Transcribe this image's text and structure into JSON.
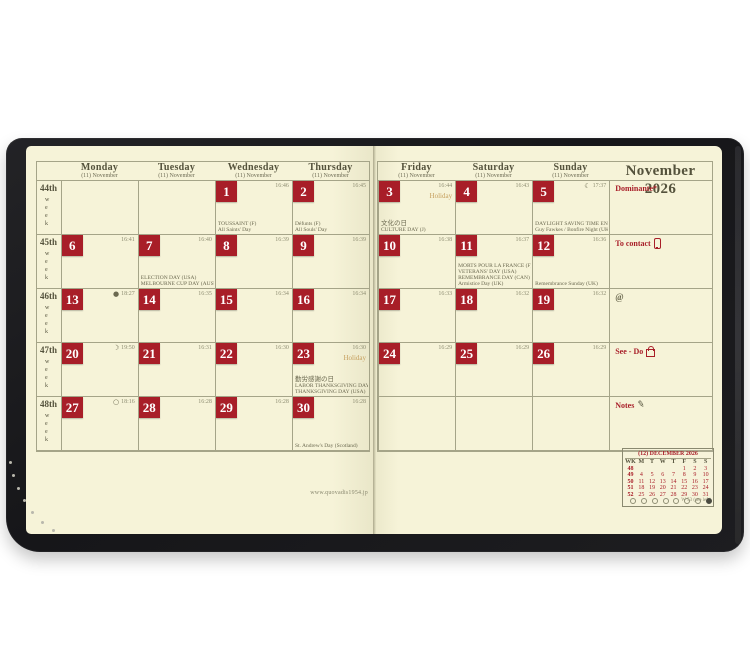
{
  "brand_url": "www.quovadis1954.jp",
  "colors": {
    "paper": "#f6f3d8",
    "cover": "#1a1a1d",
    "red": "#a81e28",
    "ink": "#54523c",
    "grid": "#a5a488",
    "faint": "#8e8d72",
    "tan": "#c6a05f",
    "note": "#6b6950"
  },
  "left_page": {
    "headers": [
      {
        "name": "Monday",
        "sub": "(11) November"
      },
      {
        "name": "Tuesday",
        "sub": "(11) November"
      },
      {
        "name": "Wednesday",
        "sub": "(11) November"
      },
      {
        "name": "Thursday",
        "sub": "(11) November"
      }
    ]
  },
  "right_page": {
    "headers": [
      {
        "name": "Friday",
        "sub": "(11) November"
      },
      {
        "name": "Saturday",
        "sub": "(11) November"
      },
      {
        "name": "Sunday",
        "sub": "(11) November"
      }
    ],
    "month_title": "November 2026",
    "sidebar": [
      {
        "label": "Dominante*",
        "icon": "none"
      },
      {
        "label": "To contact",
        "icon": "phone"
      },
      {
        "label": "@",
        "icon": "none",
        "muted": true
      },
      {
        "label": "See - Do",
        "icon": "bag"
      },
      {
        "label": "Notes",
        "icon": "pen"
      }
    ]
  },
  "weeks": [
    "44th",
    "45th",
    "46th",
    "47th",
    "48th"
  ],
  "week_word": "week",
  "grid_rows": [
    [
      null,
      null,
      {
        "day": "1",
        "time": "16:46",
        "lines": [
          "TOUSSAINT (F)",
          "All Saints' Day"
        ]
      },
      {
        "day": "2",
        "time": "16:45",
        "lines": [
          "Défunts (F)",
          "All Souls' Day"
        ]
      },
      {
        "day": "3",
        "time": "16:44",
        "holiday": "Holiday",
        "lines": [
          "文化の日",
          "CULTURE DAY (J)"
        ]
      },
      {
        "day": "4",
        "time": "16:43"
      },
      {
        "day": "5",
        "time": "17:37",
        "moon": "☾",
        "lines": [
          "DAYLIGHT SAVING TIME ENDS (CAN - USA)",
          "Guy Fawkes / Bonfire Night (UK - Northern Ireland)"
        ]
      }
    ],
    [
      {
        "day": "6",
        "time": "16:41"
      },
      {
        "day": "7",
        "time": "16:40",
        "lines": [
          "ELECTION DAY (USA)",
          "MELBOURNE CUP DAY (AUST)"
        ]
      },
      {
        "day": "8",
        "time": "16:39"
      },
      {
        "day": "9",
        "time": "16:39"
      },
      {
        "day": "10",
        "time": "16:38"
      },
      {
        "day": "11",
        "time": "16:37",
        "lines": [
          "MORTS POUR LA FRANCE (F)",
          "VETERANS' DAY (USA)",
          "REMEMBRANCE DAY (CAN)",
          "Armistice Day (UK)"
        ]
      },
      {
        "day": "12",
        "time": "16:36",
        "lines": [
          "Remembrance Sunday (UK)"
        ]
      }
    ],
    [
      {
        "day": "13",
        "time": "18:27",
        "moon": "●"
      },
      {
        "day": "14",
        "time": "16:35"
      },
      {
        "day": "15",
        "time": "16:34"
      },
      {
        "day": "16",
        "time": "16:34"
      },
      {
        "day": "17",
        "time": "16:33"
      },
      {
        "day": "18",
        "time": "16:32"
      },
      {
        "day": "19",
        "time": "16:32"
      }
    ],
    [
      {
        "day": "20",
        "time": "19:50",
        "moon": "☽"
      },
      {
        "day": "21",
        "time": "16:31"
      },
      {
        "day": "22",
        "time": "16:30"
      },
      {
        "day": "23",
        "time": "16:30",
        "holiday": "Holiday",
        "lines": [
          "勤労感謝の日",
          "LABOR THANKSGIVING DAY (J)",
          "THANKSGIVING DAY (USA)"
        ]
      },
      {
        "day": "24",
        "time": "16:29"
      },
      {
        "day": "25",
        "time": "16:29"
      },
      {
        "day": "26",
        "time": "16:29"
      }
    ],
    [
      {
        "day": "27",
        "time": "18:16",
        "moon": "○"
      },
      {
        "day": "28",
        "time": "16:28"
      },
      {
        "day": "29",
        "time": "16:28"
      },
      {
        "day": "30",
        "time": "16:28",
        "lines": [
          "St. Andrew's Day (Scotland)"
        ]
      },
      null,
      null,
      null
    ]
  ],
  "mini_calendar": {
    "title": "(12) DECEMBER 2026",
    "cols": [
      "WK",
      "M",
      "T",
      "W",
      "T",
      "F",
      "S",
      "S"
    ],
    "rows": [
      [
        "48",
        "",
        "",
        "",
        "",
        "1",
        "2",
        "3"
      ],
      [
        "49",
        "4",
        "5",
        "6",
        "7",
        "8",
        "9",
        "10"
      ],
      [
        "50",
        "11",
        "12",
        "13",
        "14",
        "15",
        "16",
        "17"
      ],
      [
        "51",
        "18",
        "19",
        "20",
        "21",
        "22",
        "23",
        "24"
      ],
      [
        "52",
        "25",
        "26",
        "27",
        "28",
        "29",
        "30",
        "31"
      ]
    ],
    "footnote": "W 53 (see left)"
  }
}
